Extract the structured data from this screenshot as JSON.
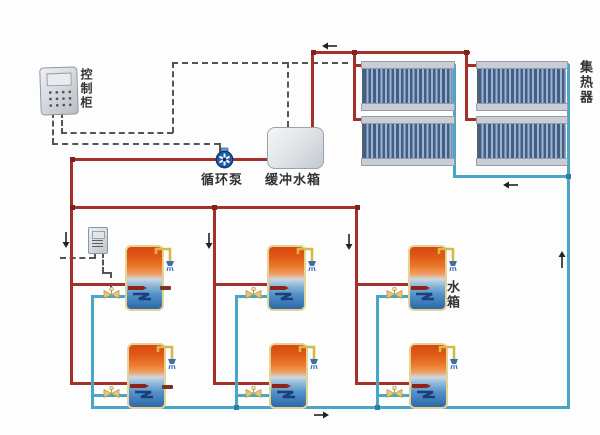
{
  "labels": {
    "control_cabinet": "控制柜",
    "circulation_pump": "循环泵",
    "buffer_tank": "缓冲水箱",
    "collector": "集热器",
    "water_tank": "水箱"
  },
  "colors": {
    "hot_pipe": "#a5302a",
    "cold_pipe": "#4aa6c8",
    "wire": "#555555",
    "collector_tube_dark": "#3f5f8a",
    "collector_tube_light": "#9fb4cc",
    "collector_header": "#c9ced6",
    "tank_border": "#e3d395",
    "valve": "#e2c878",
    "shower_pipe": "#d8b945",
    "shower_head": "#3a6fae",
    "pump_body": "#1d5fae",
    "bg": "#fdfdfd",
    "label": "#333333"
  },
  "components": {
    "collector_panels": 4,
    "storage_tanks": 6,
    "buffer_tanks": 1,
    "circulation_pumps": 1,
    "control_cabinets": 1
  }
}
